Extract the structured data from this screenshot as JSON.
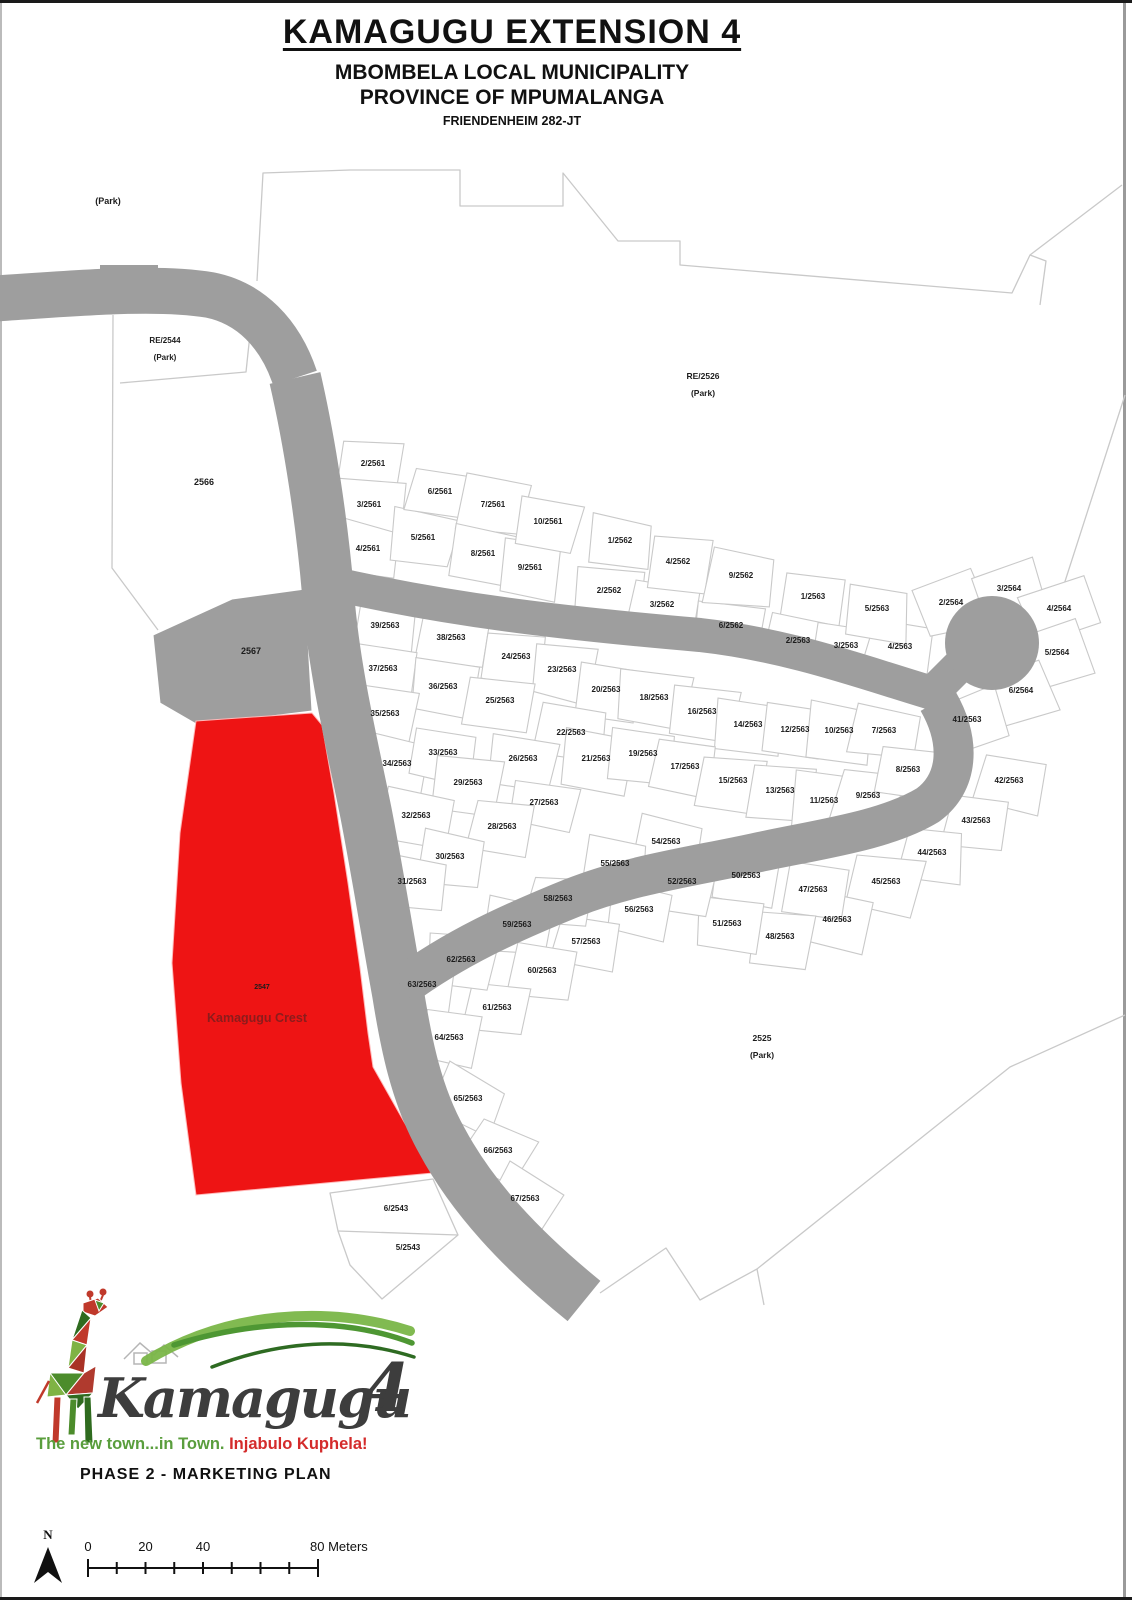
{
  "header": {
    "title": "KAMAGUGU EXTENSION 4",
    "municipality": "MBOMBELA LOCAL MUNICIPALITY",
    "province": "PROVINCE OF MPUMALANGA",
    "farm": "FRIENDENHEIM 282-JT"
  },
  "map": {
    "colors": {
      "road": "#9e9e9e",
      "parcel_stroke": "#c9c9c9",
      "highlight": "#ee1414",
      "highlight_label": "#8b1c1c",
      "label": "#1c1c1c"
    },
    "area_labels": [
      {
        "t": "(Park)",
        "x": 108,
        "y": 201,
        "s": 9
      },
      {
        "t": "RE/2544",
        "x": 165,
        "y": 340,
        "s": 8
      },
      {
        "t": "(Park)",
        "x": 165,
        "y": 357,
        "s": 8
      },
      {
        "t": "2566",
        "x": 204,
        "y": 482,
        "s": 9
      },
      {
        "t": "RE/2526",
        "x": 703,
        "y": 376,
        "s": 8.5
      },
      {
        "t": "(Park)",
        "x": 703,
        "y": 393,
        "s": 8.5
      },
      {
        "t": "2567",
        "x": 251,
        "y": 651,
        "s": 9
      },
      {
        "t": "2525",
        "x": 762,
        "y": 1038,
        "s": 8.5
      },
      {
        "t": "(Park)",
        "x": 762,
        "y": 1055,
        "s": 8.5
      },
      {
        "t": "2547",
        "x": 262,
        "y": 986,
        "s": 7
      },
      {
        "t": "Kamagugu Crest",
        "x": 257,
        "y": 1019,
        "s": 12.5,
        "c": "#8b1c1c"
      }
    ],
    "parcel_labels": [
      {
        "t": "2/2561",
        "x": 373,
        "y": 463
      },
      {
        "t": "3/2561",
        "x": 369,
        "y": 504
      },
      {
        "t": "4/2561",
        "x": 368,
        "y": 548
      },
      {
        "t": "5/2561",
        "x": 423,
        "y": 537
      },
      {
        "t": "6/2561",
        "x": 440,
        "y": 491
      },
      {
        "t": "7/2561",
        "x": 493,
        "y": 504
      },
      {
        "t": "8/2561",
        "x": 483,
        "y": 553
      },
      {
        "t": "9/2561",
        "x": 530,
        "y": 567
      },
      {
        "t": "10/2561",
        "x": 548,
        "y": 521
      },
      {
        "t": "1/2562",
        "x": 620,
        "y": 540
      },
      {
        "t": "2/2562",
        "x": 609,
        "y": 590
      },
      {
        "t": "3/2562",
        "x": 662,
        "y": 604
      },
      {
        "t": "4/2562",
        "x": 678,
        "y": 561
      },
      {
        "t": "6/2562",
        "x": 731,
        "y": 625
      },
      {
        "t": "9/2562",
        "x": 741,
        "y": 575
      },
      {
        "t": "1/2563",
        "x": 813,
        "y": 596
      },
      {
        "t": "2/2563",
        "x": 798,
        "y": 640
      },
      {
        "t": "3/2563",
        "x": 846,
        "y": 645
      },
      {
        "t": "4/2563",
        "x": 900,
        "y": 646
      },
      {
        "t": "5/2563",
        "x": 877,
        "y": 608
      },
      {
        "t": "2/2564",
        "x": 951,
        "y": 602
      },
      {
        "t": "3/2564",
        "x": 1009,
        "y": 588
      },
      {
        "t": "4/2564",
        "x": 1059,
        "y": 608
      },
      {
        "t": "5/2564",
        "x": 1057,
        "y": 652
      },
      {
        "t": "6/2564",
        "x": 1021,
        "y": 690
      },
      {
        "t": "39/2563",
        "x": 385,
        "y": 625
      },
      {
        "t": "38/2563",
        "x": 451,
        "y": 637
      },
      {
        "t": "24/2563",
        "x": 516,
        "y": 656
      },
      {
        "t": "23/2563",
        "x": 562,
        "y": 669
      },
      {
        "t": "20/2563",
        "x": 606,
        "y": 689
      },
      {
        "t": "18/2563",
        "x": 654,
        "y": 697
      },
      {
        "t": "16/2563",
        "x": 702,
        "y": 711
      },
      {
        "t": "14/2563",
        "x": 748,
        "y": 724
      },
      {
        "t": "12/2563",
        "x": 795,
        "y": 729
      },
      {
        "t": "10/2563",
        "x": 839,
        "y": 730
      },
      {
        "t": "7/2563",
        "x": 884,
        "y": 730
      },
      {
        "t": "41/2563",
        "x": 967,
        "y": 719
      },
      {
        "t": "37/2563",
        "x": 383,
        "y": 668
      },
      {
        "t": "36/2563",
        "x": 443,
        "y": 686
      },
      {
        "t": "25/2563",
        "x": 500,
        "y": 700
      },
      {
        "t": "22/2563",
        "x": 571,
        "y": 732
      },
      {
        "t": "21/2563",
        "x": 596,
        "y": 758
      },
      {
        "t": "19/2563",
        "x": 643,
        "y": 753
      },
      {
        "t": "17/2563",
        "x": 685,
        "y": 766
      },
      {
        "t": "15/2563",
        "x": 733,
        "y": 780
      },
      {
        "t": "13/2563",
        "x": 780,
        "y": 790
      },
      {
        "t": "11/2563",
        "x": 824,
        "y": 800
      },
      {
        "t": "9/2563",
        "x": 868,
        "y": 795
      },
      {
        "t": "8/2563",
        "x": 908,
        "y": 769
      },
      {
        "t": "35/2563",
        "x": 385,
        "y": 713
      },
      {
        "t": "34/2563",
        "x": 397,
        "y": 763
      },
      {
        "t": "33/2563",
        "x": 443,
        "y": 752
      },
      {
        "t": "26/2563",
        "x": 523,
        "y": 758
      },
      {
        "t": "29/2563",
        "x": 468,
        "y": 782
      },
      {
        "t": "27/2563",
        "x": 544,
        "y": 802
      },
      {
        "t": "32/2563",
        "x": 416,
        "y": 815
      },
      {
        "t": "28/2563",
        "x": 502,
        "y": 826
      },
      {
        "t": "30/2563",
        "x": 450,
        "y": 856
      },
      {
        "t": "31/2563",
        "x": 412,
        "y": 881
      },
      {
        "t": "42/2563",
        "x": 1009,
        "y": 780
      },
      {
        "t": "43/2563",
        "x": 976,
        "y": 820
      },
      {
        "t": "44/2563",
        "x": 932,
        "y": 852
      },
      {
        "t": "45/2563",
        "x": 886,
        "y": 881
      },
      {
        "t": "46/2563",
        "x": 837,
        "y": 919
      },
      {
        "t": "47/2563",
        "x": 813,
        "y": 889
      },
      {
        "t": "48/2563",
        "x": 780,
        "y": 936
      },
      {
        "t": "50/2563",
        "x": 746,
        "y": 875
      },
      {
        "t": "51/2563",
        "x": 727,
        "y": 923
      },
      {
        "t": "52/2563",
        "x": 682,
        "y": 881
      },
      {
        "t": "54/2563",
        "x": 666,
        "y": 841
      },
      {
        "t": "55/2563",
        "x": 615,
        "y": 863
      },
      {
        "t": "56/2563",
        "x": 639,
        "y": 909
      },
      {
        "t": "57/2563",
        "x": 586,
        "y": 941
      },
      {
        "t": "58/2563",
        "x": 558,
        "y": 898
      },
      {
        "t": "59/2563",
        "x": 517,
        "y": 924
      },
      {
        "t": "60/2563",
        "x": 542,
        "y": 970
      },
      {
        "t": "61/2563",
        "x": 497,
        "y": 1007
      },
      {
        "t": "62/2563",
        "x": 461,
        "y": 959
      },
      {
        "t": "63/2563",
        "x": 422,
        "y": 984
      },
      {
        "t": "64/2563",
        "x": 449,
        "y": 1037
      },
      {
        "t": "65/2563",
        "x": 468,
        "y": 1098
      },
      {
        "t": "66/2563",
        "x": 498,
        "y": 1150
      },
      {
        "t": "67/2563",
        "x": 525,
        "y": 1198
      },
      {
        "t": "6/2543",
        "x": 396,
        "y": 1208
      },
      {
        "t": "5/2543",
        "x": 408,
        "y": 1247
      }
    ]
  },
  "logo": {
    "name": "Kamagugu",
    "number": "4",
    "tagline_green": "The new town...in Town. ",
    "tagline_red": "Injabulo Kuphela!"
  },
  "plan_title": "PHASE 2 - MARKETING PLAN",
  "scalebar": {
    "north": "N",
    "l0": "0",
    "l20": "20",
    "l40": "40",
    "l80": "80 Meters"
  }
}
